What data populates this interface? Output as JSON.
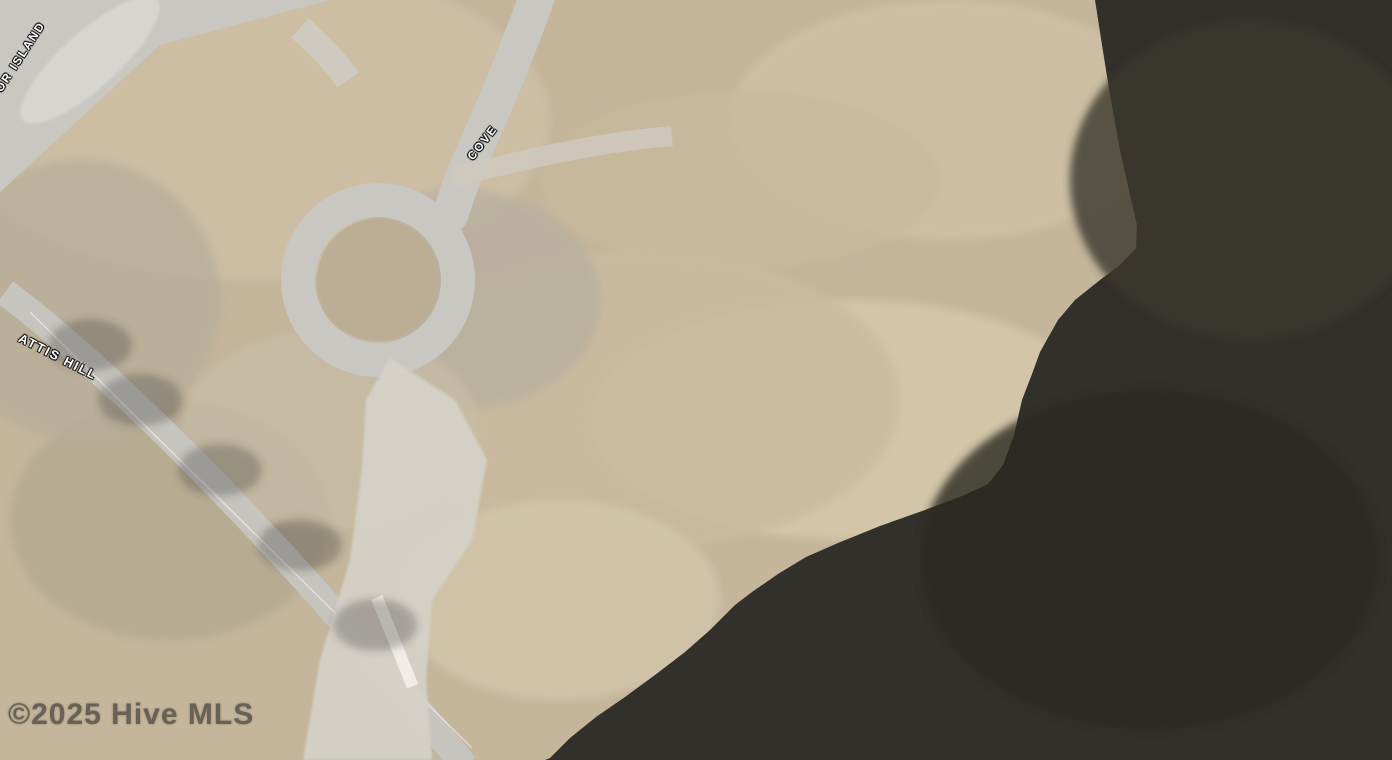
{
  "map": {
    "description": "aerial parcel map of waterfront lot with highlighted property boundary",
    "street_labels": [
      {
        "id": "or-island",
        "text": "OR ISLAND"
      },
      {
        "id": "cove",
        "text": "COVE"
      },
      {
        "id": "attis-hill",
        "text": "ATTIS HILL"
      }
    ],
    "watermark": "©2025 Hive MLS",
    "colors": {
      "boundary_orange": "#F5801D",
      "parcel_line_red": "#7A1E2E",
      "parcel_line_teal": "#2AA08E",
      "water": "#32302A",
      "road": "#C9C7C2",
      "ground": "#C4B59B",
      "pool_blue": "#8EC2E4"
    }
  }
}
